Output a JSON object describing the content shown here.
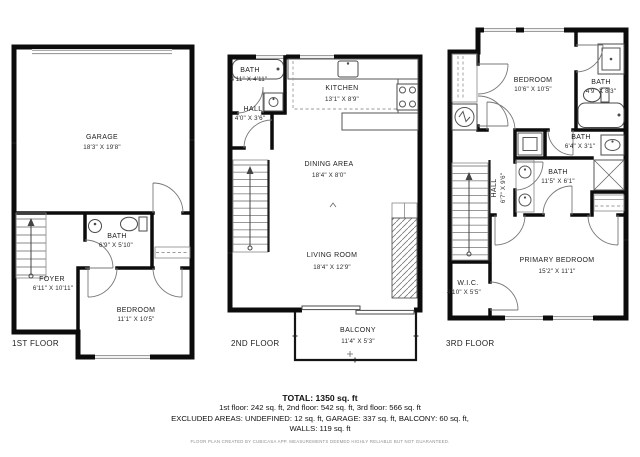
{
  "floors": {
    "f1": {
      "label": "1ST FLOOR",
      "rooms": {
        "garage": {
          "name": "GARAGE",
          "dims": "18'3\" X 19'8\""
        },
        "bath": {
          "name": "BATH",
          "dims": "6'9\" X 5'10\""
        },
        "foyer": {
          "name": "FOYER",
          "dims": "6'11\" X 10'11\""
        },
        "bedroom": {
          "name": "BEDROOM",
          "dims": "11'1\" X 10'5\""
        }
      }
    },
    "f2": {
      "label": "2ND FLOOR",
      "rooms": {
        "bath": {
          "name": "BATH",
          "dims": "4'11\" X 4'11\""
        },
        "hall": {
          "name": "HALL",
          "dims": "4'0\" X 3'6\""
        },
        "kitchen": {
          "name": "KITCHEN",
          "dims": "13'1\" X 8'9\""
        },
        "dining": {
          "name": "DINING AREA",
          "dims": "18'4\" X 8'0\""
        },
        "living": {
          "name": "LIVING ROOM",
          "dims": "18'4\" X 12'9\""
        },
        "balcony": {
          "name": "BALCONY",
          "dims": "11'4\" X 5'3\""
        }
      }
    },
    "f3": {
      "label": "3RD FLOOR",
      "rooms": {
        "bedroom": {
          "name": "BEDROOM",
          "dims": "10'6\" X 10'5\""
        },
        "bath_top": {
          "name": "BATH",
          "dims": "4'9\" X 8'3\""
        },
        "bath_mid": {
          "name": "BATH",
          "dims": "6'4\" X 3'1\""
        },
        "bath_main": {
          "name": "BATH",
          "dims": "11'5\" X 6'1\""
        },
        "hall": {
          "name": "HALL",
          "dims": "6'7\" X 9'6\""
        },
        "wic": {
          "name": "W.I.C.",
          "dims": "4'10\" X 5'5\""
        },
        "primary": {
          "name": "PRIMARY BEDROOM",
          "dims": "15'2\" X 11'1\""
        }
      }
    }
  },
  "summary": {
    "total": "TOTAL: 1350 sq. ft",
    "floors_line": "1st floor: 242 sq. ft, 2nd floor: 542 sq. ft, 3rd floor: 566 sq. ft",
    "excluded_line": "EXCLUDED AREAS: UNDEFINED: 12 sq. ft, GARAGE: 337 sq. ft, BALCONY: 60 sq. ft,",
    "walls_line": "WALLS: 119 sq. ft",
    "disclaimer": "FLOOR PLAN CREATED BY CUBICASA APP. MEASUREMENTS DEEMED HIGHLY RELIABLE BUT NOT GUARANTEED."
  },
  "colors": {
    "wall": "#0c0c0c",
    "accent_text": "#1d1d1d"
  }
}
